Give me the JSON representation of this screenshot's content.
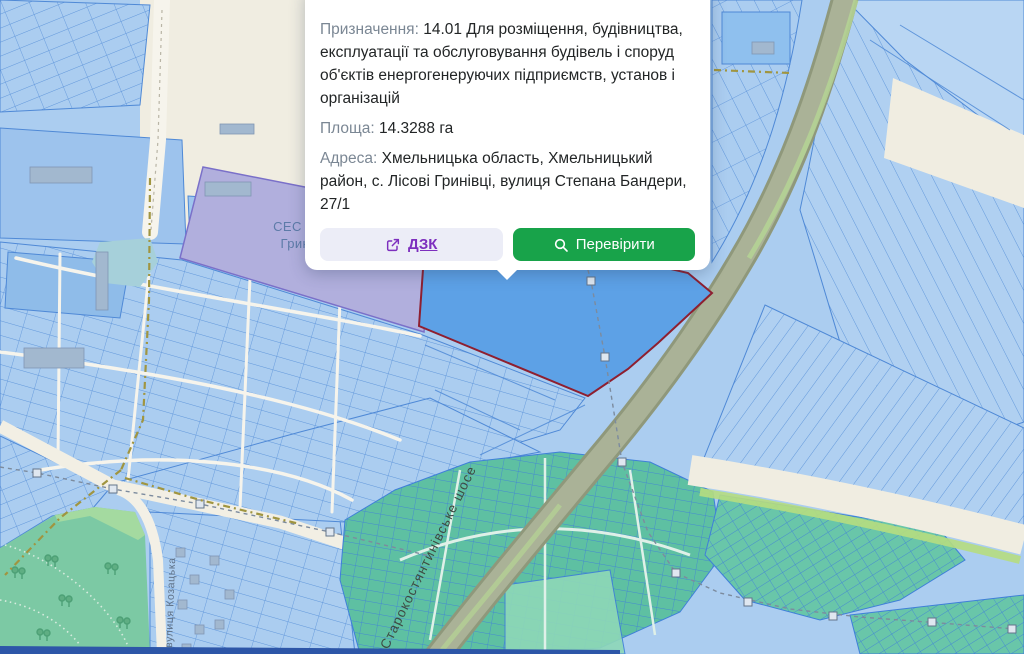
{
  "popup": {
    "designation_label": "Призначення:",
    "designation_value": "14.01 Для розміщення, будівництва, експлуатації та обслуговування будівель і споруд об'єктів енергогенеруючих підприємств, установ і організацій",
    "area_label": "Площа:",
    "area_value": "14.3288 га",
    "address_label": "Адреса:",
    "address_value": "Хмельницька область, Хмельницький район, с. Лісові Гринівці, вулиця Степана Бандери, 27/1",
    "buttons": {
      "dzk_label": "ДЗК",
      "check_label": "Перевірити"
    }
  },
  "map": {
    "labels": {
      "solar_station_line1": "СЕС «Лісові",
      "solar_station_line2": "Гринівці»",
      "highway": "Старокостянтинівське шосе",
      "street": "вулиця Козацька"
    }
  },
  "colors": {
    "accent_green": "#18a34a",
    "link_purple": "#7d2fbe",
    "dzk_bg": "#ecedf7",
    "label_gray": "#7b8794",
    "text_dark": "#222526",
    "map_cream": "#f0ede1",
    "parcel_fill": "#abcdf0",
    "parcel_stroke": "#4f89d6",
    "selected_fill": "#5da1e6",
    "selected_stroke": "#8e1f30",
    "ses_fill": "#b1afdd",
    "ses_stroke": "#7a70c9",
    "road_band": "#aab297",
    "park_green": "#7cc9a4",
    "plot_green": "#5ec0a2",
    "bright_green": "#b6dd80",
    "pond": "#a6d0da",
    "olive_dash": "#a09540"
  }
}
